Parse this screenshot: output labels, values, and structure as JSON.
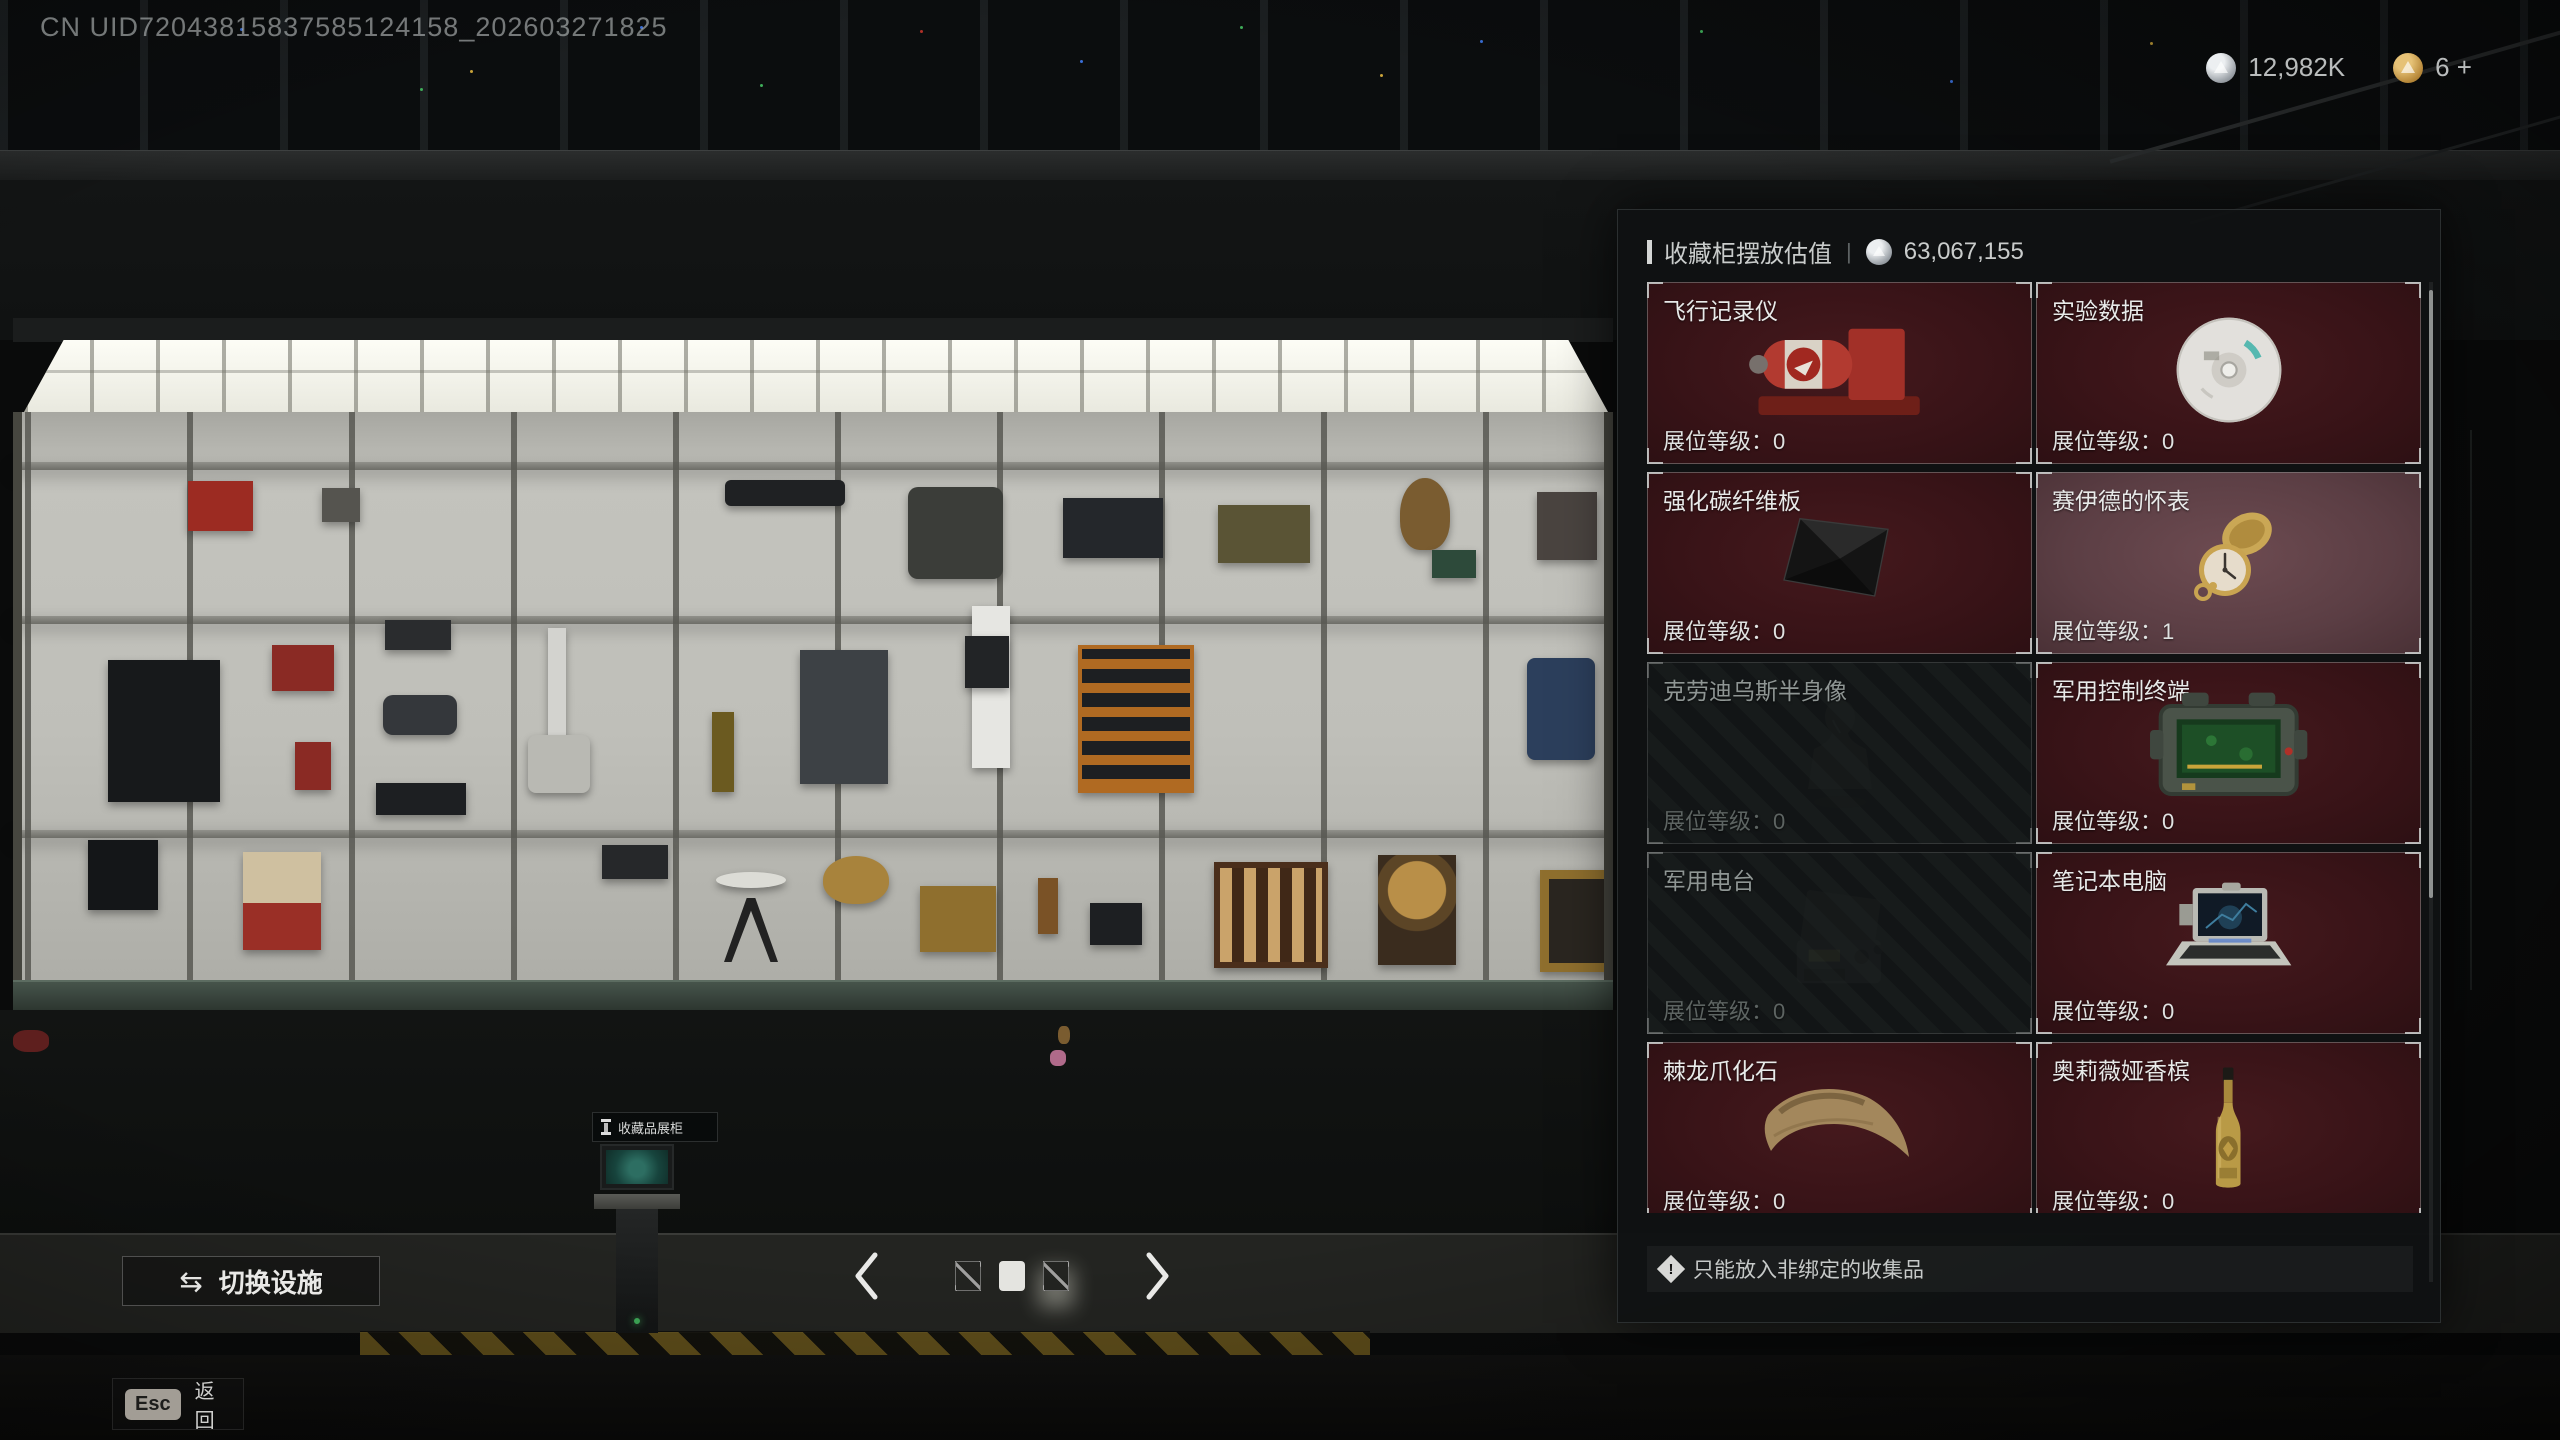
{
  "watermark": "CN UID72043815837585124158_202603271825",
  "hud": {
    "silver_amount": "12,982K",
    "gold_amount": "6 +"
  },
  "panel": {
    "title": "收藏柜摆放估值",
    "separator": "|",
    "total_value": "63,067,155",
    "footer_note": "只能放入非绑定的收集品",
    "items": [
      {
        "name": "飞行记录仪",
        "level_text": "展位等级：0",
        "state": "normal",
        "icon": "flight-recorder"
      },
      {
        "name": "实验数据",
        "level_text": "展位等级：0",
        "state": "normal",
        "icon": "data-disc"
      },
      {
        "name": "强化碳纤维板",
        "level_text": "展位等级：0",
        "state": "normal",
        "icon": "carbon-plate"
      },
      {
        "name": "赛伊德的怀表",
        "level_text": "展位等级：1",
        "state": "highlighted",
        "icon": "pocket-watch"
      },
      {
        "name": "克劳迪乌斯半身像",
        "level_text": "展位等级：0",
        "state": "disabled",
        "icon": "bust"
      },
      {
        "name": "军用控制终端",
        "level_text": "展位等级：0",
        "state": "normal",
        "icon": "military-terminal"
      },
      {
        "name": "军用电台",
        "level_text": "展位等级：0",
        "state": "disabled",
        "icon": "military-radio"
      },
      {
        "name": "笔记本电脑",
        "level_text": "展位等级：0",
        "state": "normal",
        "icon": "laptop"
      },
      {
        "name": "棘龙爪化石",
        "level_text": "展位等级：0",
        "state": "normal",
        "icon": "claw-fossil"
      },
      {
        "name": "奥莉薇娅香槟",
        "level_text": "展位等级：0",
        "state": "normal",
        "icon": "champagne"
      }
    ]
  },
  "pager": {
    "pages": [
      {
        "state": "slash"
      },
      {
        "state": "active"
      },
      {
        "state": "slash-glow"
      }
    ]
  },
  "actions": {
    "switch_facility_label": "切换设施",
    "esc_key_label": "Esc",
    "back_label": "返回"
  },
  "scene": {
    "terminal_tooltip": "收藏品展柜"
  },
  "colors": {
    "card_maroon": "#381317",
    "card_highlight": "#5b3e44",
    "card_disabled": "#151919",
    "panel_bg": "#0f1213",
    "accent_light": "#e4e4e0",
    "counter_green": "#3b4a40"
  }
}
